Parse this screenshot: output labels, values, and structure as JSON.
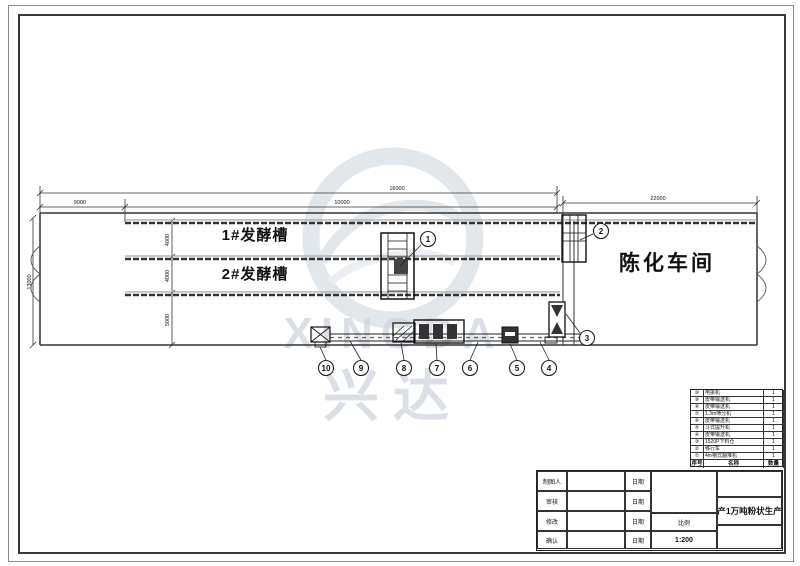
{
  "watermark": {
    "brand": "XINGDA",
    "brand_cn": "兴达",
    "color": "#ccd4de"
  },
  "drawing": {
    "trough1_label": "1#发酵槽",
    "trough2_label": "2#发酵槽",
    "aging_room_label": "陈化车间",
    "dims": {
      "top_overall": "16000",
      "top_left": "9000",
      "top_mid": "10000",
      "top_right": "22000",
      "left_height": "13000",
      "seg1": "4000",
      "seg2": "4000",
      "seg3": "5000"
    },
    "callouts": {
      "c1": "1",
      "c2": "2",
      "c3": "3",
      "c4": "4",
      "c5": "5",
      "c6": "6",
      "c7": "7",
      "c8": "8",
      "c9": "9",
      "c10": "10"
    }
  },
  "parts_table": {
    "header": {
      "no": "序号",
      "name": "名称",
      "qty": "数量"
    },
    "rows": [
      {
        "no": "⑩",
        "name": "电振机",
        "qty": "1"
      },
      {
        "no": "⑨",
        "name": "皮带输送机",
        "qty": "1"
      },
      {
        "no": "⑧",
        "name": "皮带输送机",
        "qty": "1"
      },
      {
        "no": "⑦",
        "name": "1.3m筛分机",
        "qty": "1"
      },
      {
        "no": "⑥",
        "name": "皮带输送机",
        "qty": "1"
      },
      {
        "no": "⑤",
        "name": "斗式提升机",
        "qty": "1"
      },
      {
        "no": "④",
        "name": "皮带输送机",
        "qty": "1"
      },
      {
        "no": "③",
        "name": "1520P下料仓",
        "qty": "1"
      },
      {
        "no": "②",
        "name": "移行车",
        "qty": "1"
      },
      {
        "no": "①",
        "name": "4m槽式翻堆机",
        "qty": "1"
      }
    ]
  },
  "title_block": {
    "row1_label": "制图人",
    "row2_label": "审核",
    "row3_label": "修改",
    "row4_label": "确认",
    "date_label": "日期",
    "scale_label": "比例",
    "scale_value": "1:200",
    "drawing_title": "年产1万吨粉状生产线"
  }
}
